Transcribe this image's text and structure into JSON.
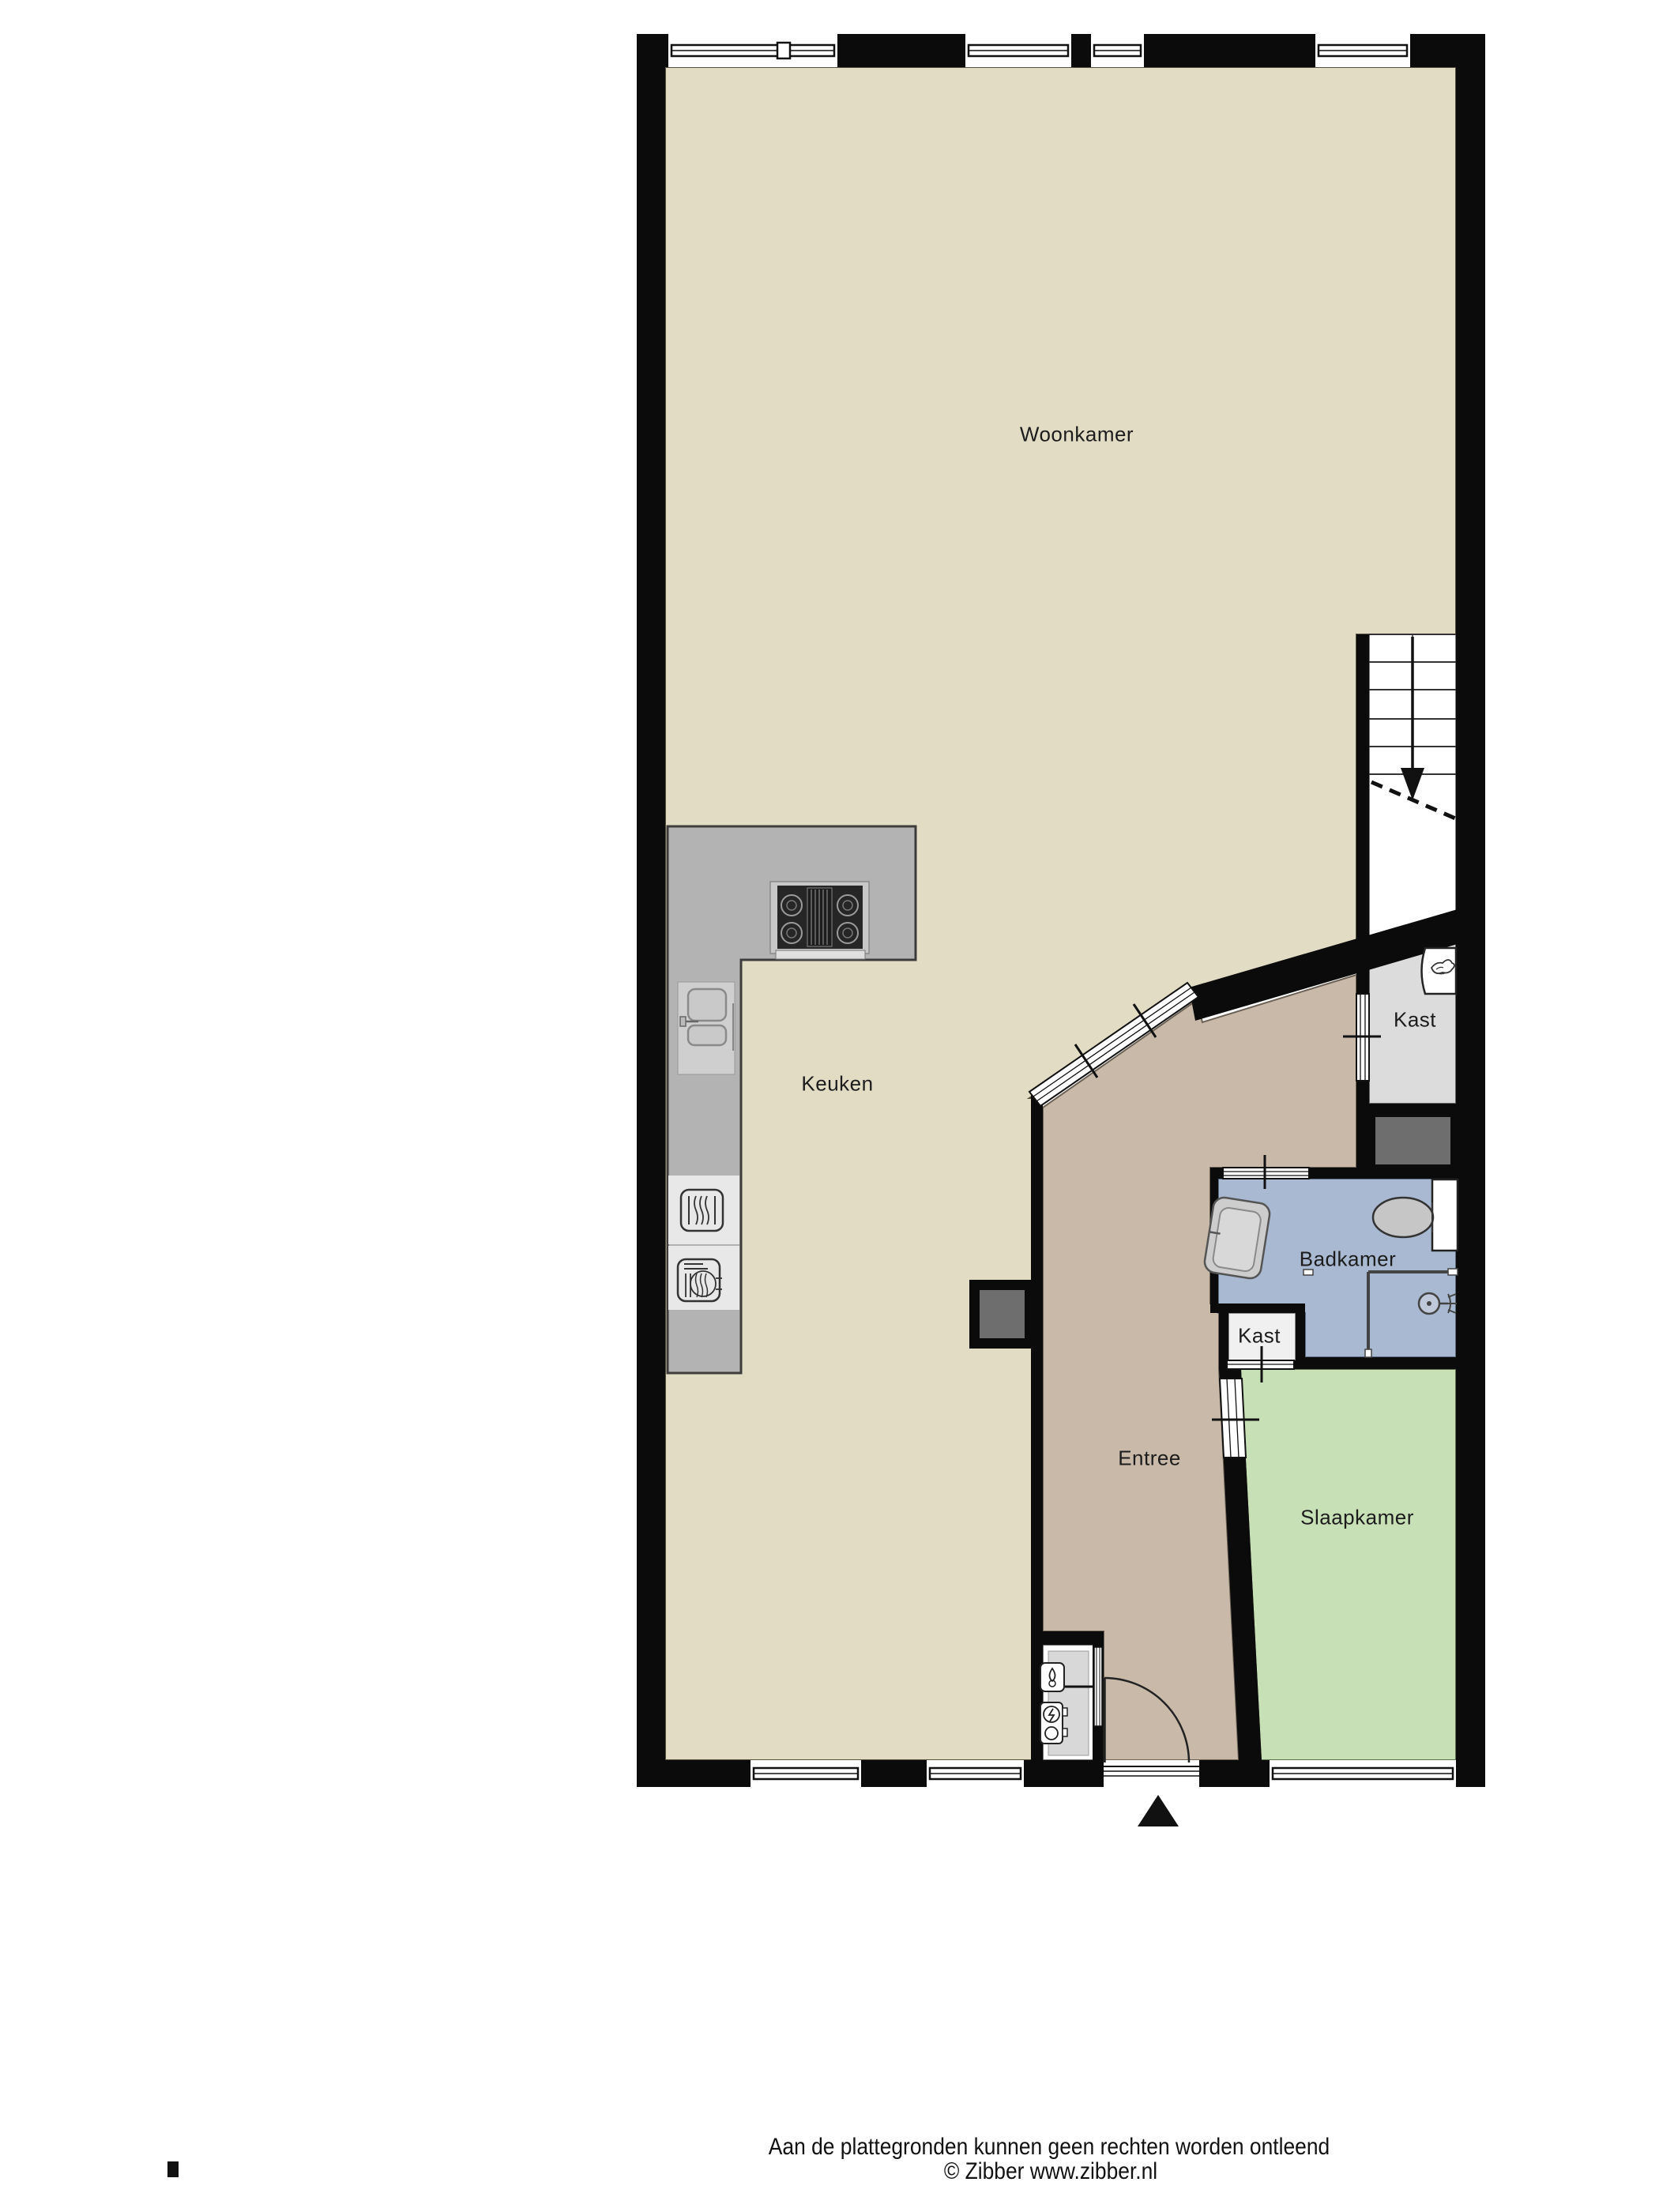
{
  "plan": {
    "rooms": [
      {
        "id": "woonkamer",
        "label": "Woonkamer"
      },
      {
        "id": "keuken",
        "label": "Keuken"
      },
      {
        "id": "kast-boven",
        "label": "Kast"
      },
      {
        "id": "badkamer",
        "label": "Badkamer"
      },
      {
        "id": "kast-onder",
        "label": "Kast"
      },
      {
        "id": "entree",
        "label": "Entree"
      },
      {
        "id": "slaapkamer",
        "label": "Slaapkamer"
      }
    ],
    "colors": {
      "floor_living": "#E3DCC5",
      "floor_entry": "#C8B9A8",
      "floor_bedroom": "#C8E0B6",
      "floor_bath": "#A8B9D1",
      "floor_closet": "#DCDCDC",
      "floor_closet_small": "#F0F0F0",
      "wall": "#0B0B0B",
      "counter": "#B3B3B3",
      "shaft": "#6E6E6E"
    },
    "icons": {
      "stairs_direction": "↓",
      "entrance_marker": "▲",
      "boiler_flame": "flame-squiggle",
      "electric_meter": "circle-bolt"
    }
  },
  "footer": {
    "line1": "Aan de plattegronden kunnen geen rechten worden ontleend",
    "line2": "© Zibber www.zibber.nl"
  }
}
